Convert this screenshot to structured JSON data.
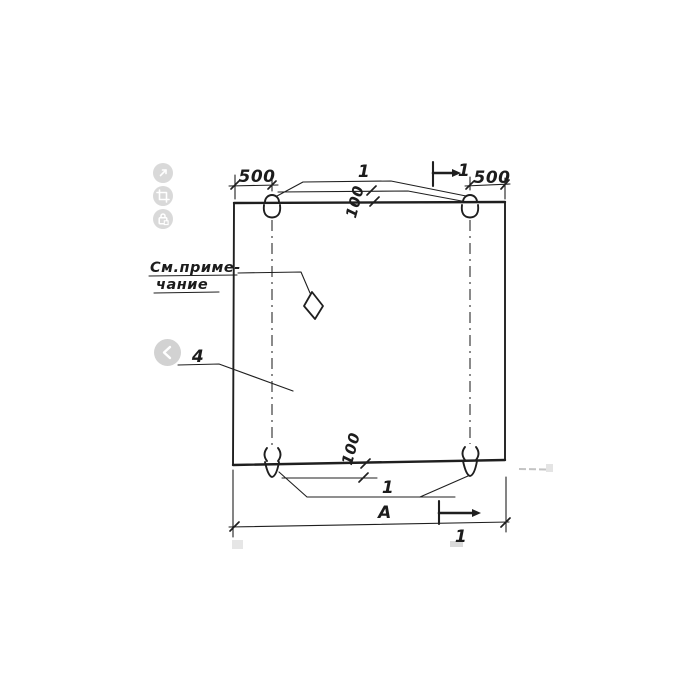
{
  "page": {
    "background": "#ffffff",
    "ink_color": "#1f1f1f",
    "ui_button_color": "#d9d9d9",
    "faint_artifact_color": "#c3c3c3"
  },
  "viewer_toolbar": {
    "buttons": [
      {
        "name": "expand",
        "icon": "expand-icon"
      },
      {
        "name": "crop",
        "icon": "crop-icon"
      },
      {
        "name": "protected",
        "icon": "lock-icon"
      }
    ]
  },
  "navigation": {
    "prev": {
      "icon": "chevron-left-icon"
    }
  },
  "drawing": {
    "type": "technical-drawing",
    "note": {
      "line1": "См.приме-",
      "line2": "чание"
    },
    "dimensions": {
      "top_left_offset": "500",
      "top_right_offset": "500",
      "top_edge_depth": "100",
      "bottom_edge_depth": "100",
      "overall_width": "А"
    },
    "callouts": {
      "lifting_loops_top": "1",
      "lifting_loops_bottom": "1",
      "panel": "4"
    },
    "section_marks": {
      "top": "1",
      "bottom": "1"
    }
  }
}
